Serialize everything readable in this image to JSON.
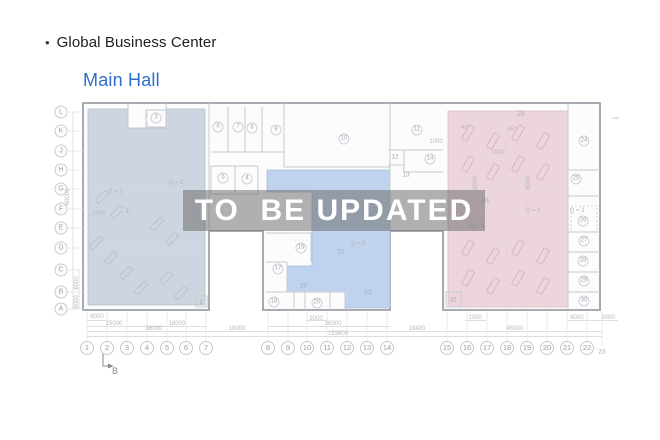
{
  "header": {
    "bullet": "•",
    "title": "Global Business Center",
    "subtitle": "Main Hall"
  },
  "watermark": {
    "text": "TO  BE UPDATED"
  },
  "colors": {
    "subtitle_blue": "#2e6ecb",
    "left_hall_fill": "#cdd5e0",
    "center_hall_fill": "#bfd3ee",
    "right_hall_fill": "#edd5dc",
    "watermark_bg": "rgba(105,105,105,0.52)"
  },
  "plan": {
    "grid_rows": [
      {
        "label": "L",
        "y": 112
      },
      {
        "label": "K",
        "y": 131
      },
      {
        "label": "J",
        "y": 151
      },
      {
        "label": "H",
        "y": 170
      },
      {
        "label": "G",
        "y": 189
      },
      {
        "label": "F",
        "y": 209
      },
      {
        "label": "E",
        "y": 228
      },
      {
        "label": "D",
        "y": 248
      },
      {
        "label": "C",
        "y": 270
      },
      {
        "label": "B",
        "y": 292
      },
      {
        "label": "A",
        "y": 309
      }
    ],
    "grid_cols": [
      {
        "label": "1",
        "x": 87
      },
      {
        "label": "2",
        "x": 107
      },
      {
        "label": "3",
        "x": 127
      },
      {
        "label": "4",
        "x": 147
      },
      {
        "label": "5",
        "x": 167
      },
      {
        "label": "6",
        "x": 186
      },
      {
        "label": "7",
        "x": 206
      },
      {
        "label": "8",
        "x": 268
      },
      {
        "label": "9",
        "x": 288
      },
      {
        "label": "10",
        "x": 307
      },
      {
        "label": "11",
        "x": 327
      },
      {
        "label": "12",
        "x": 347
      },
      {
        "label": "13",
        "x": 367
      },
      {
        "label": "14",
        "x": 387
      },
      {
        "label": "15",
        "x": 447
      },
      {
        "label": "16",
        "x": 467
      },
      {
        "label": "17",
        "x": 487
      },
      {
        "label": "18",
        "x": 507
      },
      {
        "label": "19",
        "x": 527
      },
      {
        "label": "20",
        "x": 547
      },
      {
        "label": "21",
        "x": 567
      },
      {
        "label": "22",
        "x": 587
      }
    ],
    "grid_col_plain": {
      "label": "23",
      "x": 602,
      "y": 352
    },
    "rooms_circled": [
      {
        "n": "2",
        "x": 127,
        "y": 212
      },
      {
        "n": "3",
        "x": 156,
        "y": 118
      },
      {
        "n": "4",
        "x": 247,
        "y": 179
      },
      {
        "n": "5",
        "x": 223,
        "y": 178
      },
      {
        "n": "6",
        "x": 218,
        "y": 127
      },
      {
        "n": "7",
        "x": 238,
        "y": 127
      },
      {
        "n": "8",
        "x": 252,
        "y": 128
      },
      {
        "n": "9",
        "x": 276,
        "y": 130
      },
      {
        "n": "10",
        "x": 344,
        "y": 139
      },
      {
        "n": "11",
        "x": 417,
        "y": 130
      },
      {
        "n": "14",
        "x": 430,
        "y": 159
      },
      {
        "n": "15",
        "x": 301,
        "y": 248
      },
      {
        "n": "17",
        "x": 278,
        "y": 269
      },
      {
        "n": "18",
        "x": 274,
        "y": 302
      },
      {
        "n": "20",
        "x": 317,
        "y": 303
      },
      {
        "n": "24",
        "x": 584,
        "y": 141
      },
      {
        "n": "25",
        "x": 576,
        "y": 179
      },
      {
        "n": "26",
        "x": 583,
        "y": 221
      },
      {
        "n": "27",
        "x": 584,
        "y": 241
      },
      {
        "n": "28",
        "x": 583,
        "y": 261
      },
      {
        "n": "29",
        "x": 584,
        "y": 281
      },
      {
        "n": "30",
        "x": 584,
        "y": 301
      }
    ],
    "rooms_plain": [
      {
        "n": "1",
        "x": 201,
        "y": 302
      },
      {
        "n": "12",
        "x": 395,
        "y": 157
      },
      {
        "n": "13",
        "x": 406,
        "y": 175
      },
      {
        "n": "19",
        "x": 303,
        "y": 286
      },
      {
        "n": "21",
        "x": 341,
        "y": 252
      },
      {
        "n": "22",
        "x": 368,
        "y": 293
      },
      {
        "n": "23",
        "x": 521,
        "y": 114
      },
      {
        "n": "31",
        "x": 486,
        "y": 201
      },
      {
        "n": "32",
        "x": 453,
        "y": 300
      }
    ],
    "annotations": [
      {
        "text": "Q = 3",
        "x": 115,
        "y": 192
      },
      {
        "text": "Q = 3",
        "x": 176,
        "y": 183
      },
      {
        "text": "Q = 3",
        "x": 358,
        "y": 244
      },
      {
        "text": "Q = 3",
        "x": 477,
        "y": 227
      },
      {
        "text": "Q = 3",
        "x": 533,
        "y": 211
      },
      {
        "text": "Q = 3",
        "x": 577,
        "y": 211
      },
      {
        "text": "45°",
        "x": 466,
        "y": 128
      },
      {
        "text": "45°",
        "x": 512,
        "y": 130
      },
      {
        "text": "1000",
        "x": 436,
        "y": 142
      },
      {
        "text": "1900",
        "x": 498,
        "y": 153
      },
      {
        "text": "2000",
        "x": 99,
        "y": 214
      }
    ],
    "rotated_annotations": [
      {
        "text": "6000",
        "x": 476,
        "y": 183
      },
      {
        "text": "6000",
        "x": 529,
        "y": 183
      }
    ],
    "dimensions": [
      {
        "text": "6000",
        "x": 97,
        "y": 317
      },
      {
        "text": "2000",
        "x": 316,
        "y": 319
      },
      {
        "text": "1000",
        "x": 475,
        "y": 318
      },
      {
        "text": "6000",
        "x": 577,
        "y": 318
      },
      {
        "text": "3000",
        "x": 608,
        "y": 318
      },
      {
        "text": "15000",
        "x": 114,
        "y": 324
      },
      {
        "text": "18000",
        "x": 177,
        "y": 324
      },
      {
        "text": "36000",
        "x": 333,
        "y": 324
      },
      {
        "text": "36000",
        "x": 154,
        "y": 329
      },
      {
        "text": "18000",
        "x": 237,
        "y": 329
      },
      {
        "text": "18400",
        "x": 417,
        "y": 329
      },
      {
        "text": "45000",
        "x": 515,
        "y": 329
      },
      {
        "text": "153600",
        "x": 338,
        "y": 334
      }
    ],
    "vertical_dimensions": [
      {
        "text": "60000",
        "x": 68,
        "y": 197
      },
      {
        "text": "6000",
        "x": 77,
        "y": 283
      },
      {
        "text": "6000",
        "x": 77,
        "y": 302
      }
    ],
    "section_marker": {
      "label": "B",
      "x": 115,
      "y": 371
    }
  }
}
